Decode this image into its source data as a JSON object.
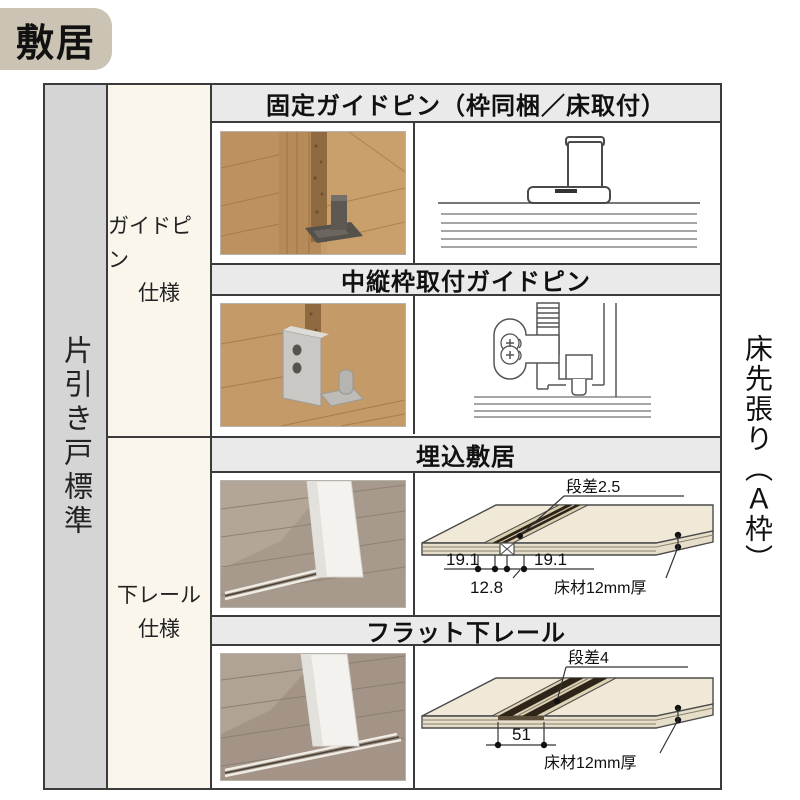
{
  "title_badge": {
    "label": "敷居"
  },
  "left_rail": {
    "label": "片引き戸標準"
  },
  "right_side": {
    "label": "床先張り（Ａ枠）"
  },
  "sections": [
    {
      "spec_line1": "ガイドピン",
      "spec_line2": "仕様",
      "rows": [
        {
          "title": "固定ガイドピン（枠同梱／床取付）"
        },
        {
          "title": "中縦枠取付ガイドピン"
        }
      ]
    },
    {
      "spec_line1": "下レール",
      "spec_line2": "仕様",
      "rows": [
        {
          "title": "埋込敷居",
          "dims": {
            "step": "段差2.5",
            "left": "19.1",
            "right": "19.1",
            "inner": "12.8",
            "floor": "床材12mm厚"
          }
        },
        {
          "title": "フラット下レール",
          "dims": {
            "step": "段差4",
            "width": "51",
            "floor": "床材12mm厚"
          }
        }
      ]
    }
  ],
  "colors": {
    "badge_bg": "#cbc4b5",
    "left_rail_bg": "#d5d5d5",
    "header_bg": "#eaeaea",
    "spec_cell_bg": "#faf6ec",
    "border": "#3b3b3b",
    "photo_wood": "#c39a68",
    "photo_floor_gray": "#a79a8d",
    "diagram_panel": "#f0e9d7",
    "diagram_rail": "#2e241a"
  }
}
